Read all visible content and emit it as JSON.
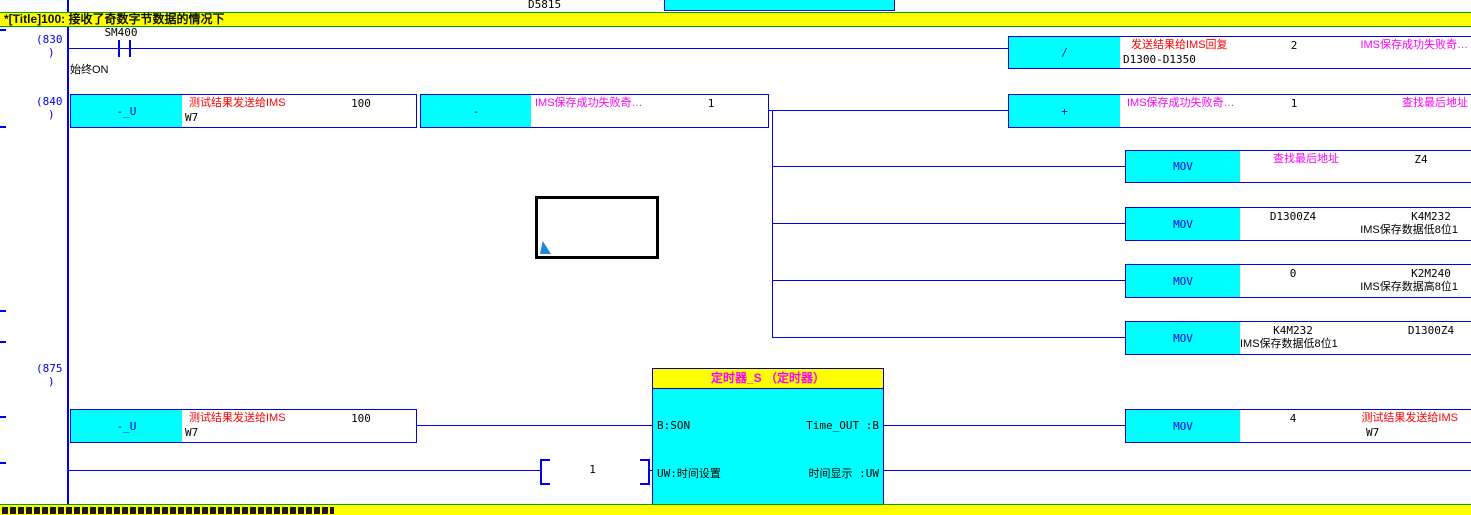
{
  "title_bar": {
    "text": "*[Title]100:  接收了奇数字节数据的情况下"
  },
  "bottom_bar": {
    "text": ""
  },
  "top_partial": {
    "device": "D5815"
  },
  "rung830": {
    "number_open": "(830",
    "number_close": ")",
    "contact": {
      "device": "SM400",
      "comment": "始终ON"
    },
    "div_block": {
      "mnemonic": "/",
      "op1_comment": "发送结果给IMS回复",
      "op1_device": "D1300-D1350",
      "op2": "2",
      "op3_label": "IMS保存成功失败奇…"
    }
  },
  "rung840": {
    "number_open": "(840",
    "number_close": ")",
    "sub_u_block": {
      "mnemonic": "-_U",
      "op1_comment": "测试结果发送给IMS",
      "op1_device": "W7",
      "op2": "100"
    },
    "sub_block": {
      "mnemonic": "-",
      "op1_label": "IMS保存成功失败奇…",
      "op2": "1"
    },
    "add_block": {
      "mnemonic": "+",
      "op1_label": "IMS保存成功失败奇…",
      "op2": "1",
      "op3_label": "查找最后地址"
    },
    "mov1": {
      "mnemonic": "MOV",
      "src_label": "查找最后地址",
      "dst_device": "Z4"
    },
    "mov2": {
      "mnemonic": "MOV",
      "src_device": "D1300Z4",
      "dst_device": "K4M232",
      "dst_comment": "IMS保存数据低8位1"
    },
    "mov3": {
      "mnemonic": "MOV",
      "src_device": "0",
      "dst_device": "K2M240",
      "dst_comment": "IMS保存数据高8位1"
    },
    "mov4": {
      "mnemonic": "MOV",
      "src_device": "K4M232",
      "src_comment": "IMS保存数据低8位1",
      "dst_device": "D1300Z4"
    }
  },
  "rung875": {
    "number_open": "(875",
    "number_close": ")",
    "sub_u_block": {
      "mnemonic": "-_U",
      "op1_comment": "测试结果发送给IMS",
      "op1_device": "W7",
      "op2": "100"
    },
    "uw_const": "1",
    "timer_block": {
      "title": "定时器_S （定时器）",
      "port_in1": "B:SON",
      "port_in2": "UW:时间设置",
      "port_out1": "Time_OUT :B",
      "port_out2": "时间显示 :UW"
    },
    "mov": {
      "mnemonic": "MOV",
      "src_device": "4",
      "dst_comment": "测试结果发送给IMS",
      "dst_device": "W7"
    }
  },
  "colors": {
    "line": "#0000f0",
    "block_fill": "#00ffff",
    "statement_bg": "#ffff00",
    "comment": "#ff0000",
    "label": "#ff00ff"
  }
}
